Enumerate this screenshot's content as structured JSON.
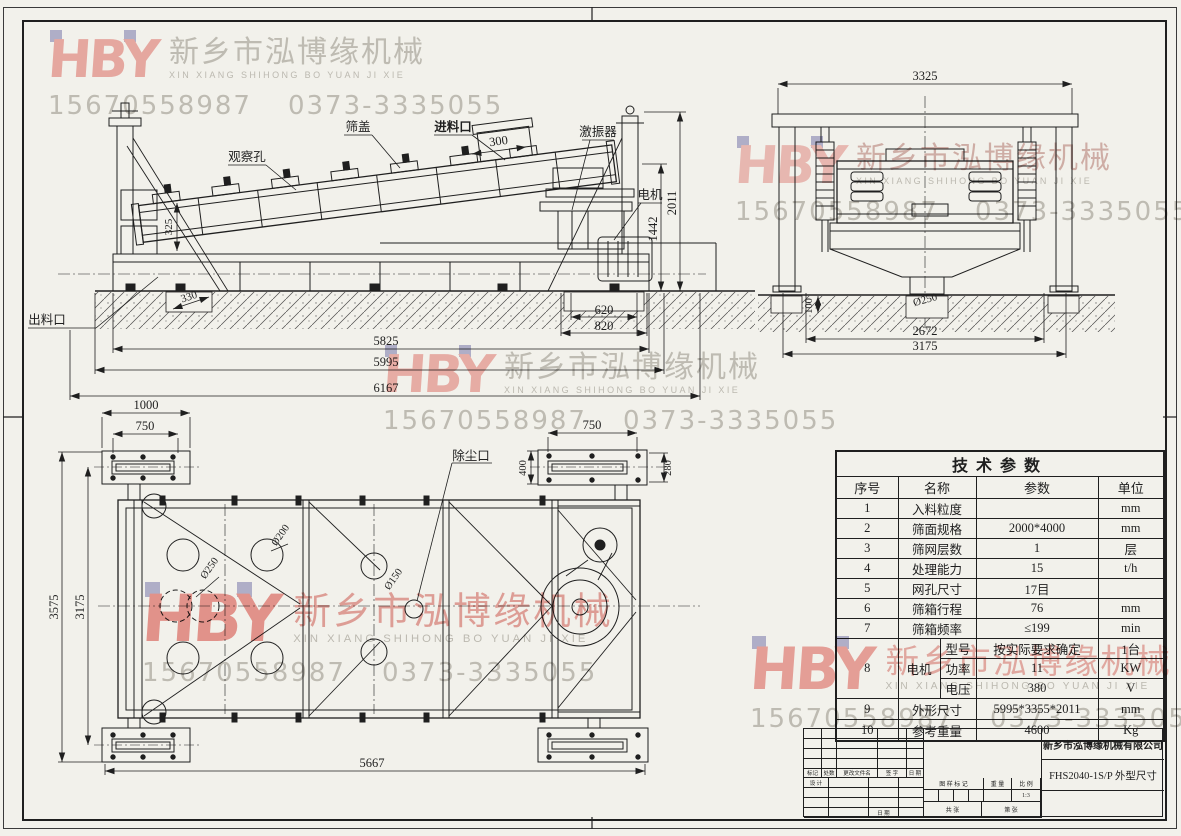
{
  "sheet": {
    "background": "#f2f1eb",
    "line_color": "#1f1f1f"
  },
  "watermark": {
    "logo": "HBY",
    "company_cn": "新乡市泓博缘机械",
    "company_en": "XIN XIANG SHIHONG BO YUAN JI XIE",
    "phone1": "15670558987",
    "phone2": "0373-3335055",
    "colors": {
      "hby_pink": "#f2b1ad",
      "hby_red": "#ee9b96",
      "square_lavender": "#b9b8d8",
      "text_gray": "#c8c6c1",
      "text_pink": "#e9a6a2"
    }
  },
  "side_view": {
    "labels": {
      "observation_hole": "观察孔",
      "screen_cover": "筛盖",
      "feed_inlet": "进料口",
      "exciter": "激振器",
      "motor": "电机",
      "discharge_outlet": "出料口"
    },
    "dims": {
      "d300": "300",
      "d325": "325",
      "d330": "330",
      "d620": "620",
      "d820": "820",
      "d5825": "5825",
      "d5995": "5995",
      "d6167": "6167",
      "d1442": "1442",
      "d2011": "2011"
    }
  },
  "end_view": {
    "dims": {
      "d3325": "3325",
      "d250": "Ø250",
      "d100": "100",
      "d2672": "2672",
      "d3175": "3175"
    }
  },
  "plan_view": {
    "labels": {
      "dust_port": "除尘口"
    },
    "dims": {
      "d1000": "1000",
      "d750l": "750",
      "d750r": "750",
      "d400": "400",
      "d280": "280",
      "dphi250": "Ø250",
      "dphi200": "Ø200",
      "dphi150": "Ø150",
      "d3575": "3575",
      "d3175": "3175",
      "d5667": "5667"
    }
  },
  "table": {
    "title": "技术参数",
    "headers": {
      "no": "序号",
      "name": "名称",
      "param": "参数",
      "unit": "单位"
    },
    "rows": [
      {
        "no": "1",
        "name": "入料粒度",
        "val": "",
        "unit": "mm"
      },
      {
        "no": "2",
        "name": "筛面规格",
        "val": "2000*4000",
        "unit": "mm"
      },
      {
        "no": "3",
        "name": "筛网层数",
        "val": "1",
        "unit": "层"
      },
      {
        "no": "4",
        "name": "处理能力",
        "val": "15",
        "unit": "t/h"
      },
      {
        "no": "5",
        "name": "网孔尺寸",
        "val": "17目",
        "unit": ""
      },
      {
        "no": "6",
        "name": "筛箱行程",
        "val": "76",
        "unit": "mm"
      },
      {
        "no": "7",
        "name": "筛箱频率",
        "val": "≤199",
        "unit": "min"
      }
    ],
    "motor": {
      "no": "8",
      "name": "电机",
      "rows": [
        {
          "sub": "型号",
          "val": "按实际要求确定",
          "unit": "1台"
        },
        {
          "sub": "功率",
          "val": "11",
          "unit": "KW"
        },
        {
          "sub": "电压",
          "val": "380",
          "unit": "V"
        }
      ]
    },
    "tail_rows": [
      {
        "no": "9",
        "name": "外形尺寸",
        "val": "5995*3355*2011",
        "unit": "mm"
      },
      {
        "no": "10",
        "name": "参考重量",
        "val": "4600",
        "unit": "Kg"
      }
    ]
  },
  "title_block": {
    "company": "新乡市泓博缘机械有限公司",
    "drawing_no": "FHS2040-1S/P  外型尺寸",
    "rev_headers": [
      "标记",
      "处数",
      "更改文件名",
      "签 字",
      "日 期"
    ],
    "design_label": "设 计",
    "date_label": "日 期",
    "mid": {
      "drawing_mark": "图 样 标 记",
      "weight": "重 量",
      "scale": "比 例",
      "scale_value": "1:3",
      "total_sheets": "共  张",
      "sheet_number": "第  张"
    }
  }
}
